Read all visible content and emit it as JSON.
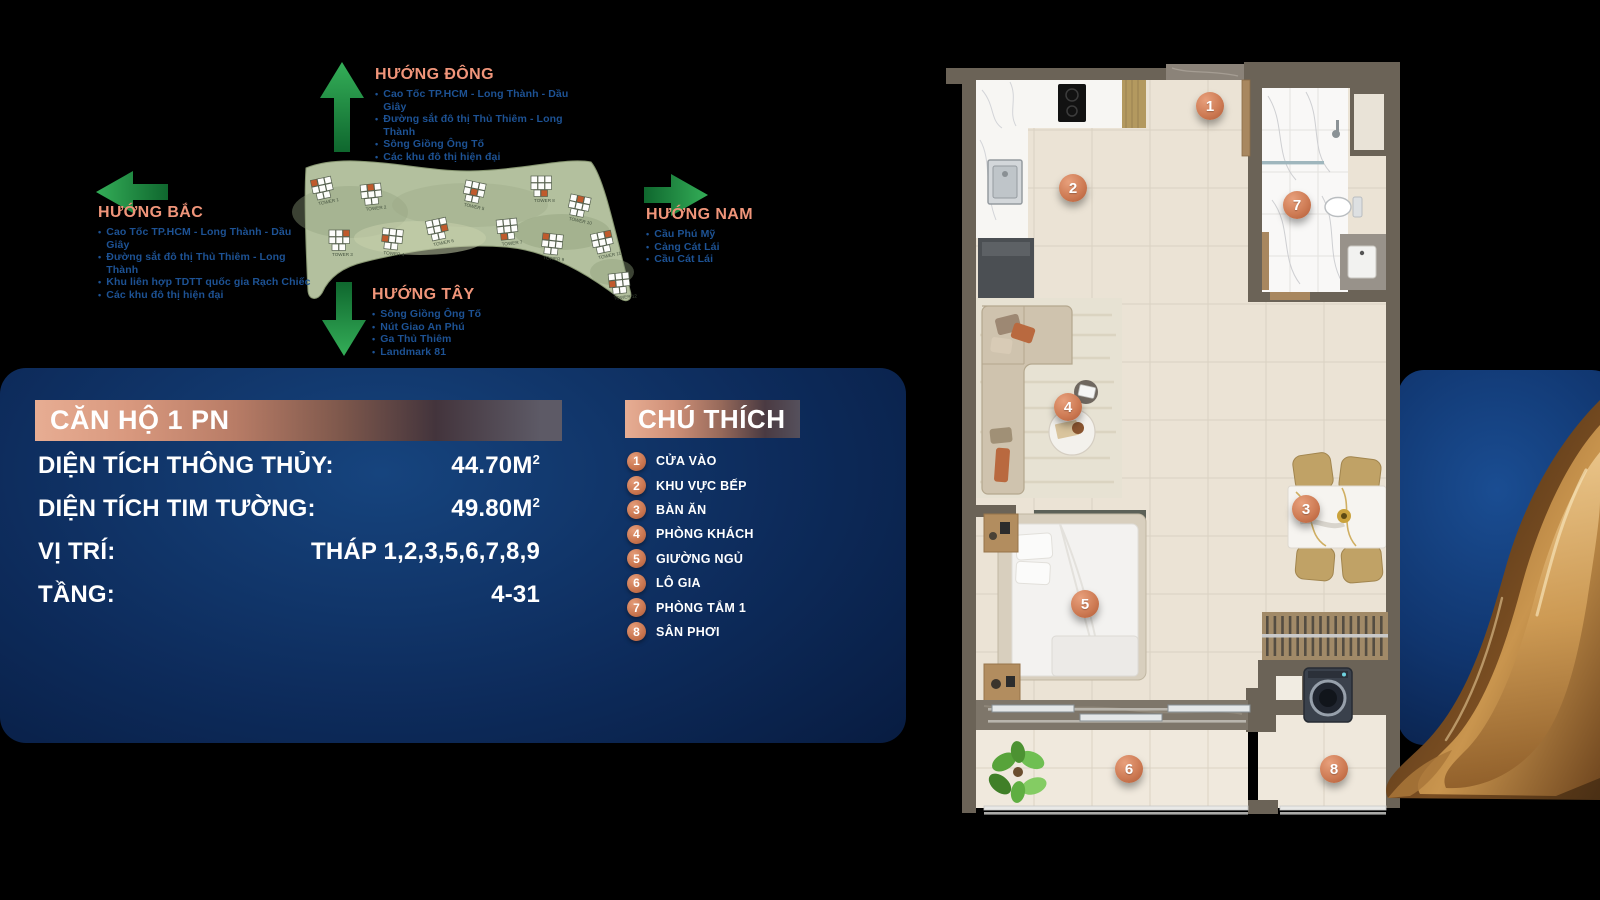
{
  "compass": {
    "east": {
      "title": "HƯỚNG ĐÔNG",
      "items": [
        "Cao Tốc TP.HCM - Long Thành - Dầu Giây",
        "Đường sắt đô thị Thủ Thiêm - Long Thành",
        "Sông Giồng Ông Tố",
        "Các khu đô thị hiện đại"
      ]
    },
    "north": {
      "title": "HƯỚNG BẮC",
      "items": [
        "Cao Tốc TP.HCM - Long Thành - Dầu Giây",
        "Đường sắt đô thị Thủ Thiêm - Long Thành",
        "Khu liên hợp TDTT quốc gia Rạch Chiếc",
        "Các khu đô thị hiện đại"
      ]
    },
    "south": {
      "title": "HƯỚNG NAM",
      "items": [
        "Cầu Phú Mỹ",
        "Cảng Cát Lái",
        "Cầu Cát Lái"
      ]
    },
    "west": {
      "title": "HƯỚNG TÂY",
      "items": [
        "Sông Giồng Ông Tố",
        "Nút Giao An Phú",
        "Ga Thủ Thiêm",
        "Landmark 81"
      ]
    }
  },
  "site_map": {
    "towers": [
      "TOWER 1",
      "TOWER 2",
      "TOWER 3",
      "TOWER 4",
      "TOWER 5",
      "TOWER 6",
      "TOWER 7",
      "TOWER 8",
      "TOWER 9",
      "TOWER 10",
      "TOWER 11",
      "TOWER 12"
    ]
  },
  "apartment_panel": {
    "title": "CĂN HỘ 1 PN",
    "rows": [
      {
        "label": "DIỆN TÍCH THÔNG THỦY:",
        "value": "44.70M",
        "sup": "2"
      },
      {
        "label": "DIỆN TÍCH TIM TƯỜNG:",
        "value": "49.80M",
        "sup": "2"
      },
      {
        "label": "VỊ TRÍ:",
        "value": "THÁP 1,2,3,5,6,7,8,9",
        "sup": ""
      },
      {
        "label": "TẦNG:",
        "value": "4-31",
        "sup": ""
      }
    ]
  },
  "legend": {
    "title": "CHÚ THÍCH",
    "items": [
      {
        "number": "1",
        "label": "CỬA VÀO"
      },
      {
        "number": "2",
        "label": "KHU VỰC BẾP"
      },
      {
        "number": "3",
        "label": "BÀN ĂN"
      },
      {
        "number": "4",
        "label": "PHÒNG KHÁCH"
      },
      {
        "number": "5",
        "label": "GIƯỜNG NGỦ"
      },
      {
        "number": "6",
        "label": "LÔ GIA"
      },
      {
        "number": "7",
        "label": "PHÒNG TẮM 1"
      },
      {
        "number": "8",
        "label": "SÂN PHƠI"
      }
    ]
  },
  "colors": {
    "accent_salmon": "#f0957a",
    "accent_bronze": "#cd7a53",
    "arrow_green": "#239b48",
    "landmark_blue": "#1d5294",
    "panel_navy": "#0d2b5b",
    "drape_gold": "#c9954e"
  }
}
